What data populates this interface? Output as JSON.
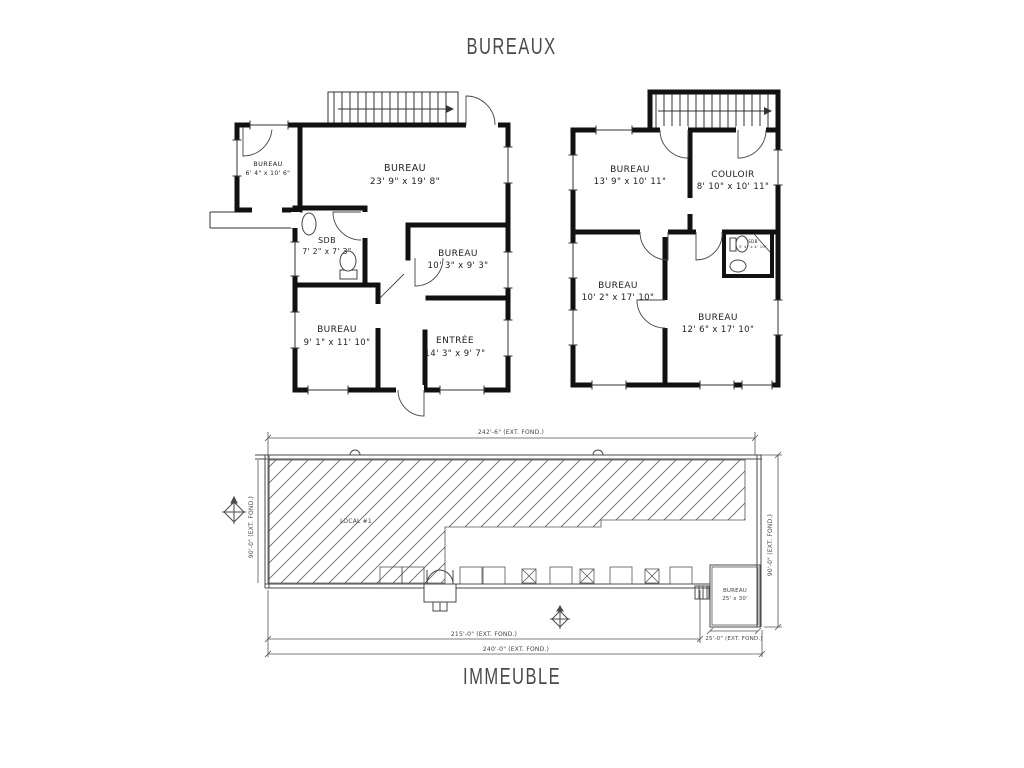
{
  "titles": {
    "top": "BUREAUX",
    "bottom": "IMMEUBLE"
  },
  "floor1": {
    "rooms": [
      {
        "name": "BUREAU",
        "dims": "6' 4\" x 10' 6\""
      },
      {
        "name": "BUREAU",
        "dims": "23' 9\" x 19' 8\""
      },
      {
        "name": "SDB",
        "dims": "7' 2\" x 7' 3\""
      },
      {
        "name": "BUREAU",
        "dims": "10' 3\" x 9' 3\""
      },
      {
        "name": "BUREAU",
        "dims": "9' 1\" x 11' 10\""
      },
      {
        "name": "ENTRÉE",
        "dims": "14' 3\" x 9' 7\""
      }
    ]
  },
  "floor2": {
    "rooms": [
      {
        "name": "BUREAU",
        "dims": "13' 9\" x 10' 11\""
      },
      {
        "name": "COULOIR",
        "dims": "8' 10\" x 10' 11\""
      },
      {
        "name": "SDB",
        "dims": "3' 4\" x 4' 10\""
      },
      {
        "name": "BUREAU",
        "dims": "10' 2\" x 17' 10\""
      },
      {
        "name": "BUREAU",
        "dims": "12' 6\" x 17' 10\""
      }
    ]
  },
  "building": {
    "local_label": "LOCAL #1",
    "room": {
      "name": "BUREAU",
      "dims": "25' x 30'"
    },
    "dims": {
      "top": "242'-6\" (EXT. FOND.)",
      "bottom_inner": "215'-0\" (EXT. FOND.)",
      "bottom_outer": "240'-0\" (EXT. FOND.)",
      "left": "90'-0\" (EXT. FOND.)",
      "right": "90'-0\" (EXT. FOND.)",
      "bureau": "25'-0\" (EXT. FOND.)"
    }
  },
  "colors": {
    "wall": "#111111",
    "scan_line": "#4a4a4a",
    "label": "#222222"
  }
}
